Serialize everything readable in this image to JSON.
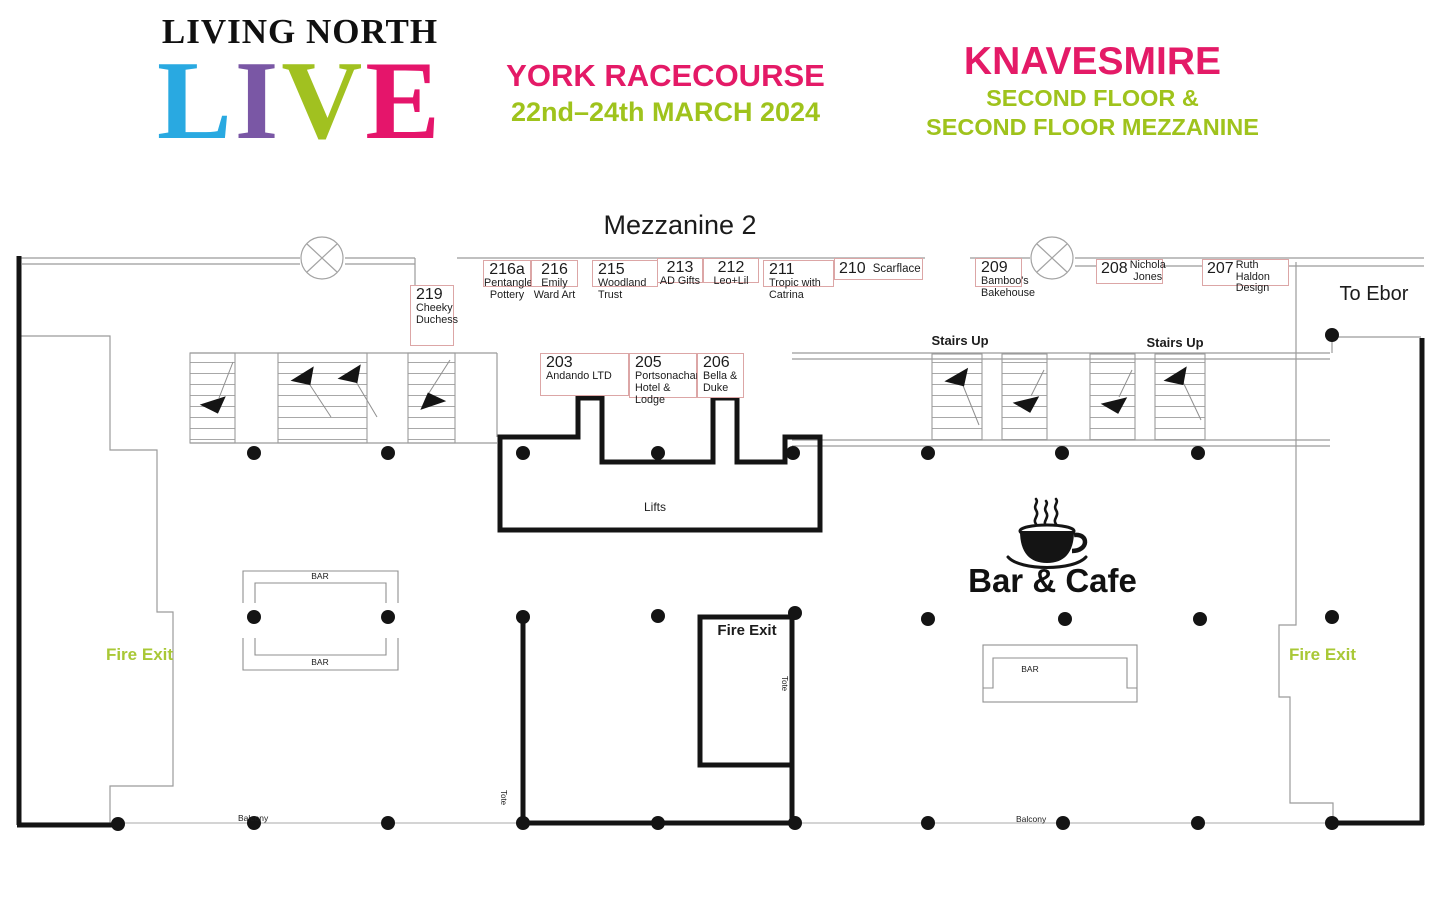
{
  "colors": {
    "pink": "#e41a67",
    "green": "#9fc31c",
    "fire_exit_green": "#a9c836",
    "live_l": "#29a9e1",
    "live_i": "#7a57a5",
    "live_v": "#a1c120",
    "live_e": "#e5156b",
    "stand_border": "#dca6a6",
    "wall_thin": "#9b9b9b",
    "wall_thick": "#141414"
  },
  "header": {
    "brand": "LIVING NORTH",
    "live_letters": [
      "L",
      "I",
      "V",
      "E"
    ],
    "venue": "YORK RACECOURSE",
    "dates": "22nd–24th MARCH 2024",
    "location": "KNAVESMIRE",
    "floor_line1": "SECOND FLOOR &",
    "floor_line2": "SECOND FLOOR MEZZANINE"
  },
  "plan": {
    "title": "Mezzanine 2",
    "to_ebor": "To Ebor",
    "lifts_label": "Lifts",
    "bar_cafe_label": "Bar & Cafe",
    "stairs_up_label": "Stairs Up",
    "fire_exit_label": "Fire Exit",
    "bar_label": "BAR",
    "tote_label": "Tote",
    "balcony_label": "Balcony"
  },
  "stands": {
    "top": [
      {
        "number": "216a",
        "name": "Pentangle Pottery"
      },
      {
        "number": "216",
        "name": "Emily Ward Art"
      },
      {
        "number": "215",
        "name": "Woodland Trust"
      },
      {
        "number": "213",
        "name": "AD Gifts"
      },
      {
        "number": "212",
        "name": "Leo+Lil"
      },
      {
        "number": "211",
        "name": "Tropic with Catrina"
      },
      {
        "number": "210",
        "name": "Scarflace"
      },
      {
        "number": "209",
        "name": "Bamboo's Bakehouse"
      },
      {
        "number": "208",
        "name": "Nichola Jones"
      },
      {
        "number": "207",
        "name": "Ruth Haldon Design"
      }
    ],
    "middle": [
      {
        "number": "203",
        "name": "Andando LTD"
      },
      {
        "number": "205",
        "name": "Portsonachan Hotel & Lodge"
      },
      {
        "number": "206",
        "name": "Bella & Duke"
      }
    ],
    "side": {
      "number": "219",
      "name": "Cheeky Duchess"
    }
  }
}
